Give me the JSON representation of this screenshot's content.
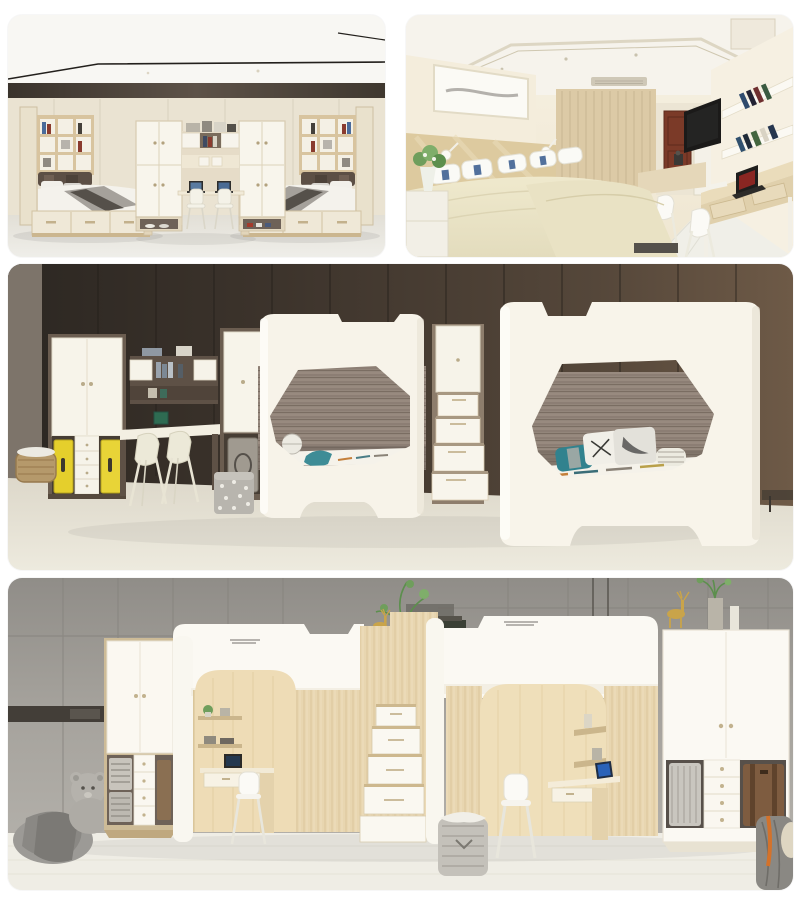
{
  "collage": {
    "background": "#ffffff",
    "panels": [
      {
        "id": "top-left",
        "alt": "Twin kids bedroom with captain beds, bookshelf headboards, two white wardrobes and a shared double study desk"
      },
      {
        "id": "top-right",
        "alt": "Hotel style twin bedroom with cream bedding, wood slat feature wall, wall mounted TV, book shelves and a long study desk with white chairs"
      },
      {
        "id": "middle",
        "alt": "Two white capsule bunk beds with hexagonal wood-lined openings and a staircase of storage drawers beside a wardrobe and study desk against a dark panelled wall"
      },
      {
        "id": "bottom",
        "alt": "Two loft beds with built-in study desks under them, a central storage staircase and wardrobes with open suitcase compartments against a grey panelled wall"
      }
    ],
    "palette": {
      "cream": "#f7f3e9",
      "wood_light": "#e4d2ab",
      "wood_mid": "#d9c5a0",
      "wood_dark": "#6b5d50",
      "wall_beige": "#eae3d2",
      "wall_dark": "#42392f",
      "wall_grey": "#a29f9a",
      "floor_light": "#e9e7e0",
      "teal": "#3e8c96",
      "yellow": "#e5cf2c",
      "door_red": "#7b3a28",
      "tv_black": "#1b1a19"
    }
  }
}
